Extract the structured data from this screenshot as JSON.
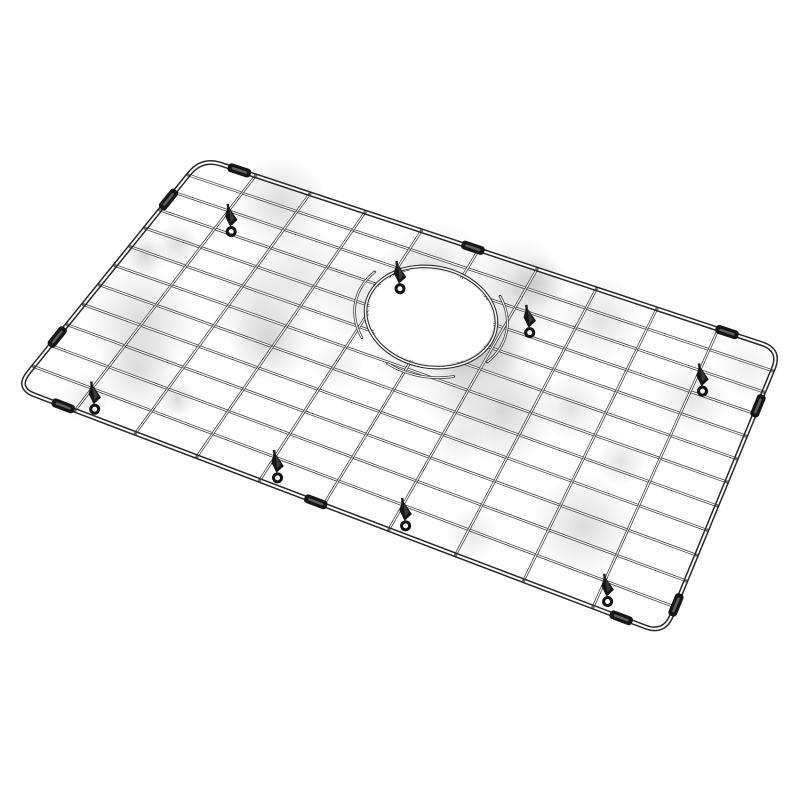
{
  "page": {
    "background_color": "#ffffff",
    "content_type": "product photograph",
    "subject": "Stainless steel kitchen sink bottom grid / sink protector rack with rear drain hole, shown in perspective on a plain white background"
  },
  "product": {
    "description": "Wire sink-bottom grid with rounded-corner outer frame, crosshatch wire lattice, circular drain cutout ring set rear-center, dark rubber feet hanging at interior junctions and dark rubber bumper sleeves clipped along all four frame rails",
    "colors": {
      "wire_outline": "#2a2a2a",
      "wire_inner": "#3d3d3d",
      "wire_highlight": "#ffffff",
      "rubber_parts": "#161616",
      "soft_shading": "#8f8f8f",
      "background": "#ffffff"
    }
  },
  "geometry": {
    "canvas": {
      "width": 800,
      "height": 800
    },
    "frame_corners": {
      "top_left": [
        202,
        158
      ],
      "top_right": [
        781,
        350
      ],
      "bottom_right": [
        664,
        634
      ],
      "bottom_left": [
        16,
        388
      ]
    },
    "frame_corner_radius": 20,
    "grid": {
      "columns": 10,
      "rows": 12
    },
    "drain_hole": {
      "cx": 431,
      "cy": 317,
      "rx": 66,
      "ry": 50,
      "rotation_deg": 11,
      "outer_bulge_rx": 77,
      "outer_bulge_ry": 60
    },
    "feet_uv": [
      {
        "u": 0.1,
        "v": 0.1667
      },
      {
        "u": 0.4,
        "v": 0.1667
      },
      {
        "u": 0.62,
        "v": 0.1667
      },
      {
        "u": 0.9,
        "v": 0.1667
      },
      {
        "u": 0.1,
        "v": 0.9167
      },
      {
        "u": 0.4,
        "v": 0.9167
      },
      {
        "u": 0.6,
        "v": 0.9167
      },
      {
        "u": 0.9,
        "v": 0.9167
      }
    ],
    "bumpers_uv": [
      {
        "u": 0.07,
        "v": 0
      },
      {
        "u": 0.49,
        "v": 0
      },
      {
        "u": 0.914,
        "v": 0
      },
      {
        "u": 0.08,
        "v": 1
      },
      {
        "u": 0.488,
        "v": 1
      },
      {
        "u": 0.94,
        "v": 1
      },
      {
        "u": 0,
        "v": 0.2
      },
      {
        "u": 0,
        "v": 0.8
      },
      {
        "u": 1,
        "v": 0.22
      },
      {
        "u": 1,
        "v": 0.91
      }
    ]
  }
}
